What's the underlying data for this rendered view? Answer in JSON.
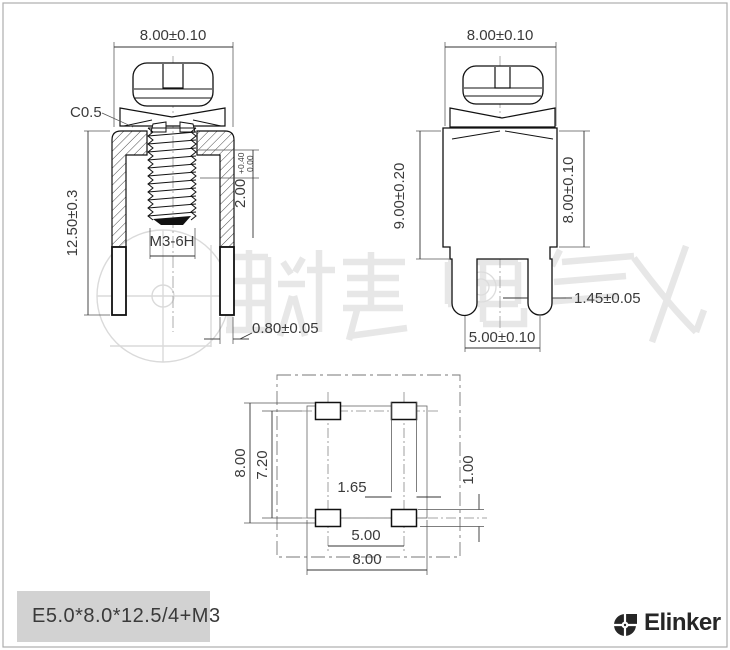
{
  "part": {
    "title": "E5.0*8.0*12.5/4+M3"
  },
  "brand": {
    "name": "Elinker"
  },
  "watermark": {
    "text": "联捷电气"
  },
  "views": {
    "front": {
      "width": "8.00±0.10",
      "height": "12.50±0.3",
      "chamfer": "C0.5",
      "screw_depth": "2.00",
      "screw_depth_tol_upper": "+0.40",
      "screw_depth_tol_lower": "0.00",
      "thread": "M3-6H",
      "pin_thickness": "0.80±0.05"
    },
    "side": {
      "width": "8.00±0.10",
      "overall_height": "9.00±0.20",
      "body_height": "8.00±0.10",
      "pin_width": "1.45±0.05",
      "pin_pitch": "5.00±0.10"
    },
    "footprint": {
      "overall_width": "8.00",
      "pad_span": "7.20",
      "pad_width": "1.65",
      "pad_height": "1.00",
      "pad_pitch": "5.00",
      "overall_height": "8.00"
    }
  }
}
